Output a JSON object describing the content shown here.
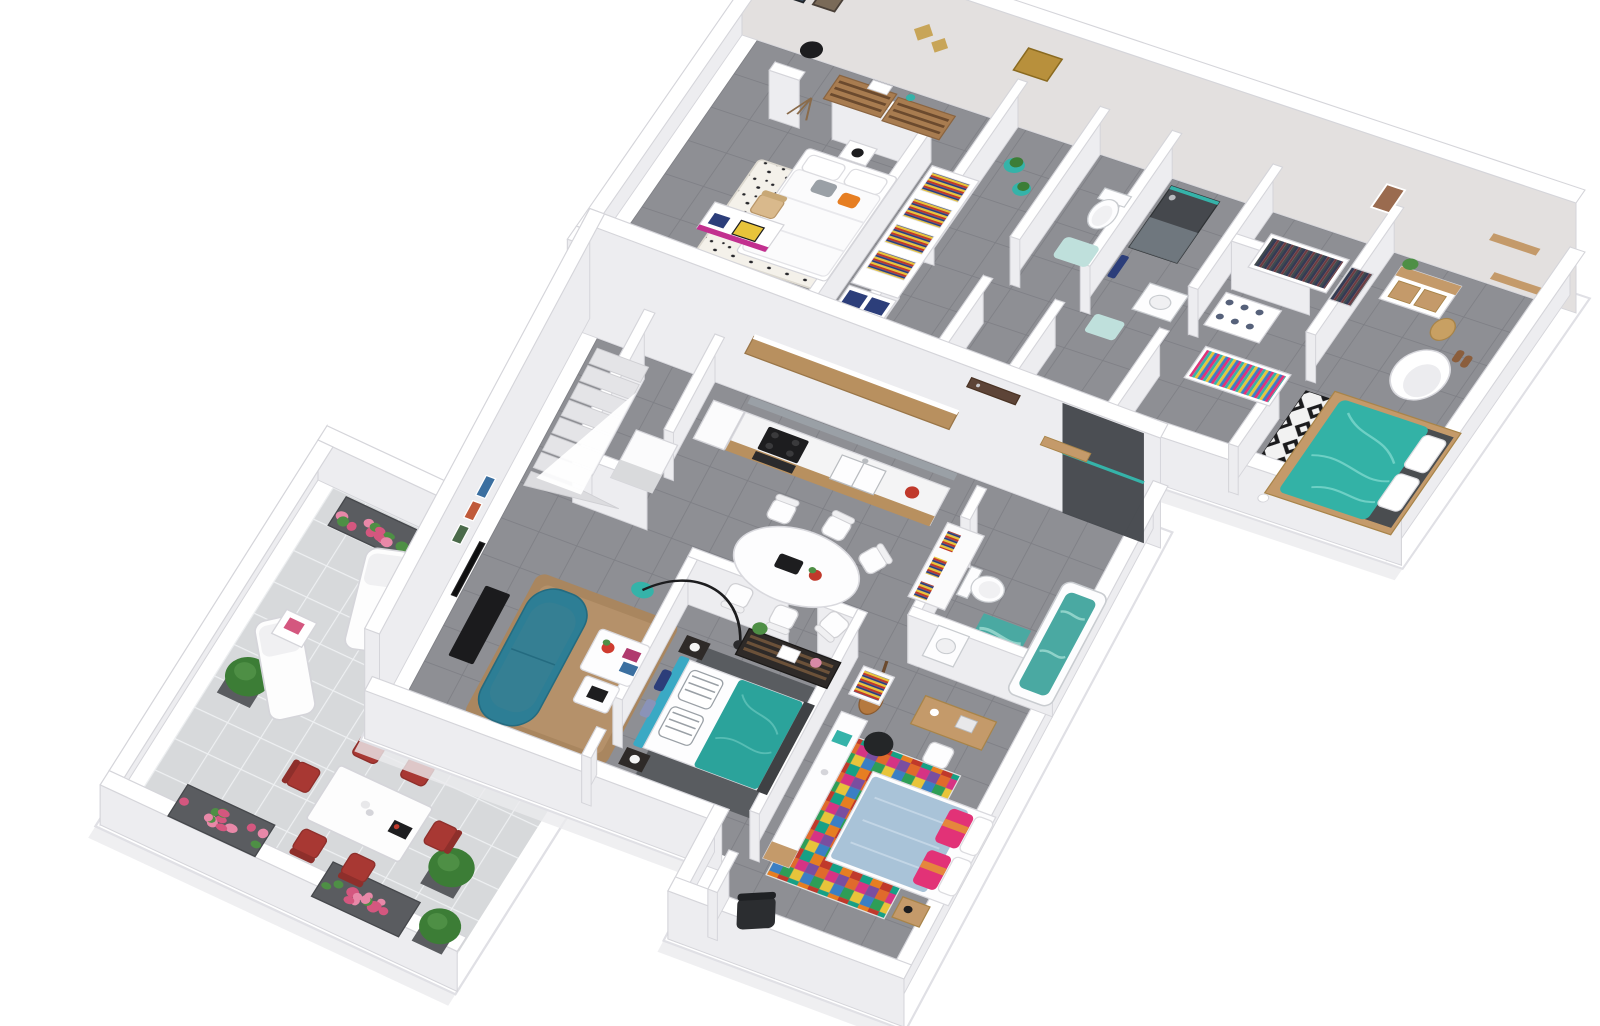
{
  "scene": {
    "type": "3d-floor-plan-render",
    "description": "Axonometric 3D floor plan rendering of a two-storey home: upper floor with two bedrooms, WC, shower room and walk-in dressing; ground floor with tiled terrace, kitchen, winder staircase, dining area, living room, two bedrooms and bathroom",
    "background": "#ffffff"
  },
  "palette": {
    "background": "#ffffff",
    "slab": "#ffffff",
    "slab_edge": "#e0e0e5",
    "slab_shadow": "#ebebee",
    "wall_top": "#ffffff",
    "wall_side": "#ededf0",
    "wall_face_dark": "#e3e0df",
    "wall_line": "#d5d5da",
    "tile_dark": "#8e8f94",
    "tile_dark_grout": "#7e7f85",
    "tile_light": "#d7d9db",
    "tile_light_grout": "#eef0f2",
    "teal_sofa": "#2d7e95",
    "teal_sofa_seat": "#357f93",
    "teal_bed": "#33b2a6",
    "teal_bed_light": "#6ed0c5",
    "teal_accent": "#35b3a9",
    "water": "#4aa9a2",
    "water_light": "#8fd2c9",
    "teal_mat": "#bfe0dc",
    "wood": "#b8905f",
    "wood_dark": "#a87c50",
    "wood_light": "#c49a6a",
    "wood_chair": "#d9b98c",
    "door_brown": "#5d4437",
    "dark_tile_wall": "#45484d",
    "red_chair": "#a83833",
    "red_bright": "#c0392b",
    "pink_flower": "#e888a8",
    "pink_deep": "#d4577f",
    "green": "#4e8f45",
    "green_dark": "#3c7d36",
    "blue_bed": "#a9c3d8",
    "blue_bed_light": "#c3d6e6",
    "pink_pillow": "#e23277",
    "orange_pillow": "#e5873d",
    "orange_accent": "#e67e22",
    "rug_brown": "#a9865f",
    "rug_brown_light": "#b5916a",
    "rug_gray": "#595c60",
    "black": "#1d1d1f",
    "dark_gray": "#3f4144",
    "charcoal": "#2b2d30",
    "navy": "#2c3e7a",
    "white": "#ffffff",
    "off_white": "#f7f7f8",
    "magenta": "#c2308f",
    "gold": "#b8903c",
    "gold_star": "#c8a558",
    "headboard_blue": "#3aa9c4",
    "gray_pillow": "#9aa0a6",
    "backsplash": "#9aa0a6",
    "steel": "#b9bcc0",
    "rug_multi_1": "#e06a2c",
    "rug_multi_2": "#d63384",
    "rug_multi_3": "#7a4ea0",
    "rug_multi_4": "#2e9e57",
    "rug_multi_5": "#e8c43a",
    "rug_multi_6": "#3b7fc4",
    "rug_multi_7": "#c0392b",
    "rug_multi_8": "#16a085",
    "rug_multi_9": "#e67e22"
  },
  "floors": [
    {
      "id": "upper-floor",
      "label": "Upper floor",
      "rooms": [
        {
          "name": "bedroom-kids",
          "furniture": [
            "single-bed",
            "desk-magenta",
            "wood-chair",
            "vanity",
            "wardrobe-shelves",
            "spotted-rug",
            "nightstand",
            "wall-art",
            "star-shelves",
            "dresser",
            "tripod-lamp"
          ]
        },
        {
          "name": "landing",
          "furniture": [
            "plant-stools",
            "gold-wall-art"
          ]
        },
        {
          "name": "wc",
          "furniture": [
            "toilet",
            "bath-mat"
          ]
        },
        {
          "name": "shower-room",
          "furniture": [
            "walk-in-shower",
            "washbasin",
            "towel",
            "bath-mat"
          ]
        },
        {
          "name": "dressing-room",
          "furniture": [
            "hanging-clothes-rack",
            "shoe-shelves",
            "bright-clothes-rack"
          ]
        },
        {
          "name": "master-bedroom",
          "furniture": [
            "double-bed-teal",
            "diamond-rug",
            "egg-chair",
            "sideboard",
            "wall-shelves",
            "basket",
            "slippers",
            "wall-art",
            "plant"
          ]
        }
      ]
    },
    {
      "id": "ground-floor",
      "label": "Ground floor",
      "rooms": [
        {
          "name": "terrace",
          "furniture": [
            "flower-planters",
            "shrub-pots",
            "sun-loungers",
            "side-table",
            "outdoor-table",
            "red-chairs"
          ]
        },
        {
          "name": "staircase",
          "furniture": [
            "winder-stairs",
            "balustrade",
            "under-stair-storage"
          ]
        },
        {
          "name": "kitchen",
          "furniture": [
            "upper-cabinets",
            "counter",
            "cooktop",
            "sink",
            "kettle",
            "tall-cabinet"
          ]
        },
        {
          "name": "entry",
          "furniture": [
            "front-door",
            "open-storage"
          ]
        },
        {
          "name": "bathroom",
          "furniture": [
            "bathtub",
            "walk-in-shower",
            "toilet",
            "washbasin",
            "towel-shelf",
            "dark-tile-wall"
          ]
        },
        {
          "name": "dining-area",
          "furniture": [
            "oval-table",
            "white-chairs",
            "arc-lamp"
          ]
        },
        {
          "name": "living-room",
          "furniture": [
            "teal-sofa",
            "brown-rug",
            "coffee-tables",
            "tv",
            "tv-console",
            "wall-frames"
          ]
        },
        {
          "name": "bedroom-1",
          "furniture": [
            "double-bed-teal",
            "gray-rug",
            "nightstands",
            "dark-dresser"
          ]
        },
        {
          "name": "bedroom-2",
          "furniture": [
            "double-bed-blue",
            "multicolor-rug",
            "sideboard",
            "desk",
            "guitar",
            "pouf",
            "armchair",
            "bookshelf",
            "nightstand"
          ]
        }
      ]
    }
  ]
}
